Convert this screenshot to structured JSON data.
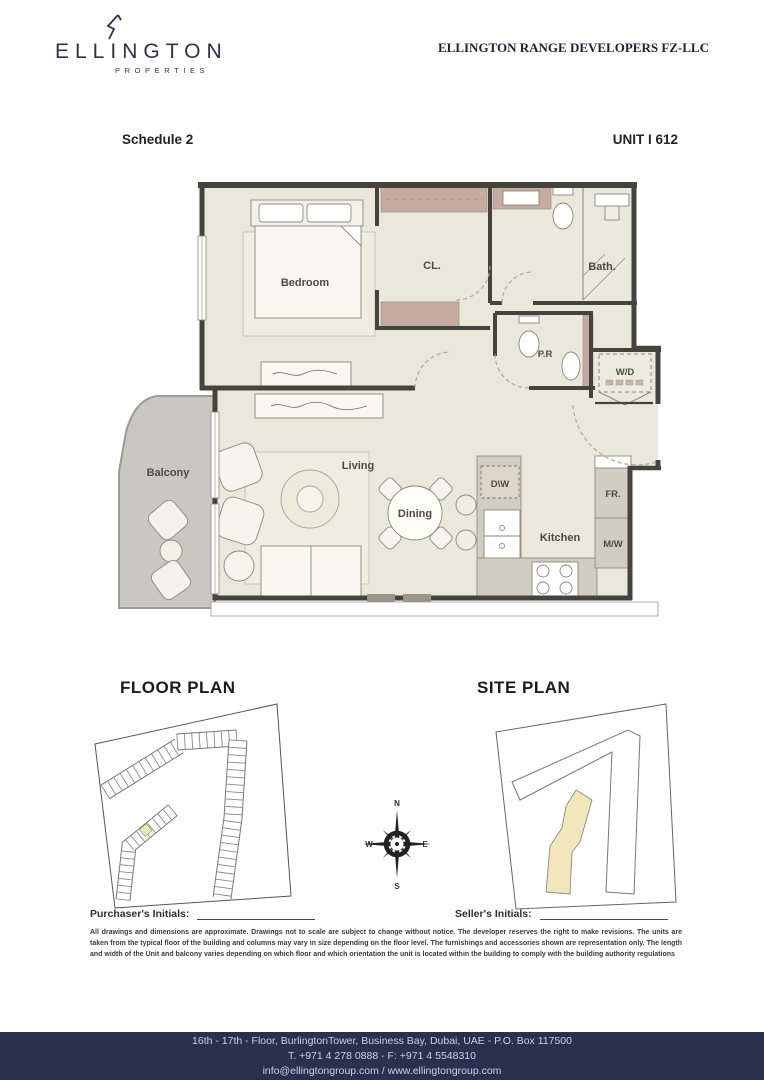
{
  "header": {
    "brand": "ELLINGTON",
    "brand_sub": "PROPERTIES",
    "company": "ELLINGTON RANGE DEVELOPERS FZ-LLC"
  },
  "meta": {
    "schedule": "Schedule 2",
    "unit": "UNIT I 612"
  },
  "floorplan": {
    "rooms": {
      "bedroom": "Bedroom",
      "closet": "CL.",
      "bath": "Bath.",
      "powder": "P.R",
      "washer_dryer": "W/D",
      "balcony": "Balcony",
      "living": "Living",
      "dining": "Dining",
      "kitchen": "Kitchen",
      "dishwasher": "D\\W",
      "fridge": "FR.",
      "microwave": "M/W"
    }
  },
  "plans": {
    "floor_plan_title": "FLOOR PLAN",
    "site_plan_title": "SITE PLAN"
  },
  "compass": {
    "north": "N",
    "east": "E",
    "south": "S",
    "west": "W"
  },
  "signatures": {
    "purchaser_label": "Purchaser's Initials:",
    "seller_label": "Seller's Initials:"
  },
  "disclaimer": "All drawings and dimensions are approximate. Drawings not to scale are subject to change without notice. The developer reserves the right to make revisions. The units are taken from the typical floor of the building and columns may vary in size depending on the floor level. The furnishings and accessories shown are representation only. The length and width of the Unit and balcony varies depending on which floor and which orientation the unit is located within the building to comply with the building authority regulations",
  "footer": {
    "address": "16th - 17th - Floor, BurlingtonTower, Business Bay, Dubai, UAE - P.O. Box 117500",
    "phone": "T. +971 4 278 0888 - F: +971 4 5548310",
    "web": "info@ellingtongroup.com / www.ellingtongroup.com"
  },
  "colors": {
    "navy": "#2a3150",
    "floor": "#e9e8db",
    "wall": "#45433e",
    "cabinet": "#c5aba2",
    "counter": "#d3ccc0",
    "balcony": "#c9c7c2",
    "highlight": "#f2e6bd"
  }
}
